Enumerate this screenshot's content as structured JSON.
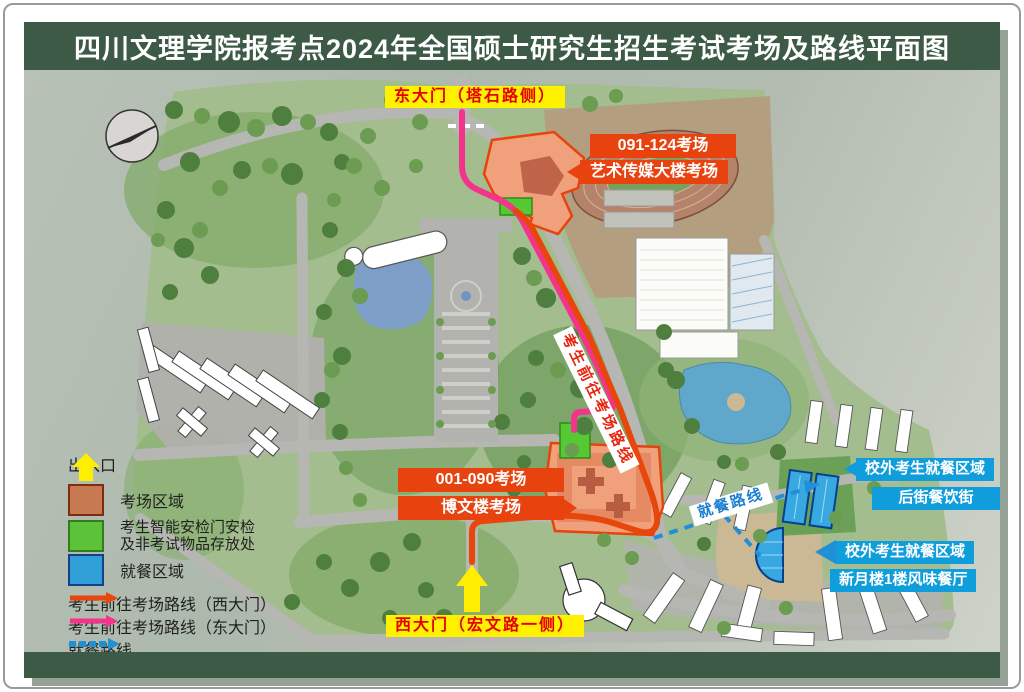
{
  "title": "四川文理学院报考点2024年全国硕士研究生招生考试考场及路线平面图",
  "labels": {
    "east_gate": "东大门（塔石路侧）",
    "west_gate": "西大门（宏文路一侧）",
    "art_rooms": "091-124考场",
    "art_building": "艺术传媒大楼考场",
    "bowen_rooms": "001-090考场",
    "bowen_building": "博文楼考场",
    "exam_route": "考生前往考场路线",
    "dining_route": "就餐路线",
    "dining1_title": "校外考生就餐区域",
    "dining1_name": "后街餐饮街",
    "dining2_title": "校外考生就餐区域",
    "dining2_name": "新月楼1楼风味餐厅"
  },
  "legend": {
    "entrance": "出入口",
    "exam_area": "考场区域",
    "checkpoint_line1": "考生智能安检门安检",
    "checkpoint_line2": "及非考试物品存放处",
    "dining_area": "就餐区域",
    "route_west": "考生前往考场路线（西大门）",
    "route_east": "考生前往考场路线（东大门）",
    "route_dining": "就餐路线"
  },
  "colors": {
    "title_bar": "#3c5a46",
    "exam_label_bg": "#e8430f",
    "gate_label_bg": "#fff100",
    "gate_label_text": "#e60000",
    "dining_label_bg": "#0f9ddb",
    "route_west": "#e8470c",
    "route_east": "#f4348c",
    "route_dining": "#1f8fd6",
    "exam_area_fill": "#f1a07c",
    "checkpoint_fill": "#55c832",
    "dining_area_fill": "#37a8e0",
    "entrance_arrow": "#ffee00"
  }
}
